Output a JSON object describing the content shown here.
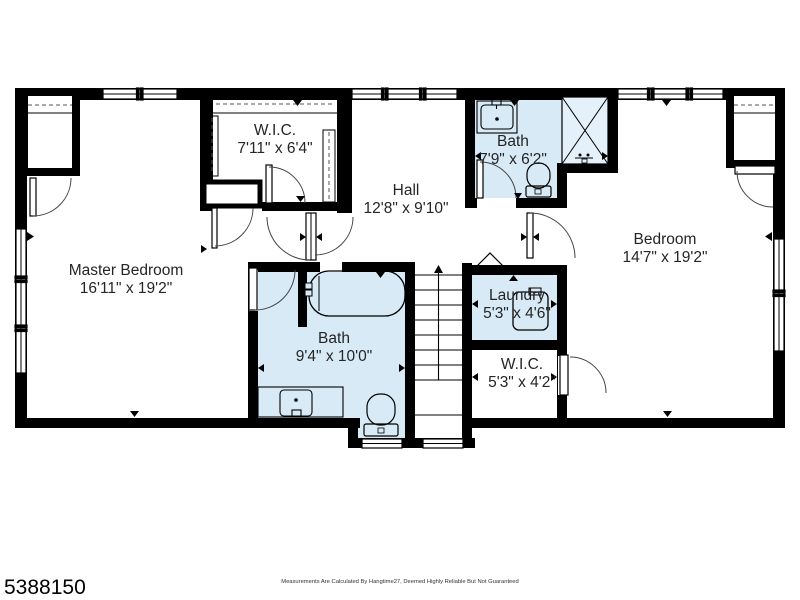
{
  "page": {
    "background": "#ffffff",
    "mls_number": "5388150",
    "disclaimer": "Measurements Are Calculated By Hangtime27, Deemed Highly Reliable But Not Guaranteed"
  },
  "colors": {
    "wall": "#000000",
    "wet_room_fill": "#d9eaf7",
    "shower_fill": "#e4f0fa",
    "text": "#252525"
  },
  "rooms": [
    {
      "id": "master-bedroom",
      "name": "Master Bedroom",
      "dims": "16'11\" x 19'2\""
    },
    {
      "id": "wic-upper",
      "name": "W.I.C.",
      "dims": "7'11\" x 6'4\""
    },
    {
      "id": "hall",
      "name": "Hall",
      "dims": "12'8\" x 9'10\""
    },
    {
      "id": "bath-upper",
      "name": "Bath",
      "dims": "7'9\" x 6'2\""
    },
    {
      "id": "bedroom",
      "name": "Bedroom",
      "dims": "14'7\" x 19'2\""
    },
    {
      "id": "bath-lower",
      "name": "Bath",
      "dims": "9'4\" x 10'0\""
    },
    {
      "id": "laundry",
      "name": "Laundry",
      "dims": "5'3\" x 4'6\""
    },
    {
      "id": "wic-lower",
      "name": "W.I.C.",
      "dims": "5'3\" x 4'2\""
    }
  ]
}
